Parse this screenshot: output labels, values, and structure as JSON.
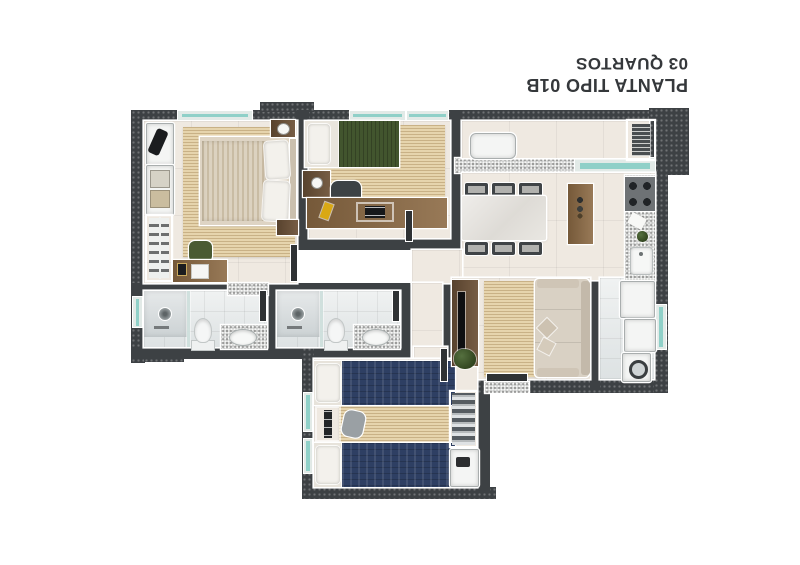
{
  "title": {
    "line1": "PLANTA TIPO 01B",
    "line2": "03 QUARTOS"
  },
  "colors": {
    "title": "#35383b",
    "wall": "#3d4144",
    "outline": "#ffffff",
    "floor": "#efe9e1",
    "bath": "#e3e6e7",
    "rug": "#e6d4ad",
    "rugline": "rgba(146,112,62,0.35)",
    "wood": "#8c6a44",
    "wooddark": "#6e5339",
    "navy": "#2e3f63",
    "greenbed": "#42552e",
    "greenchair": "#4a5a33",
    "sofa": "#d9d1c4",
    "granite": "#cdcecc",
    "glass": "#8fd0c8",
    "glassframe": "#e2eae7",
    "appliance": "#f4f5f4",
    "cooktop": "#6e7275",
    "dark": "#2f3234"
  }
}
